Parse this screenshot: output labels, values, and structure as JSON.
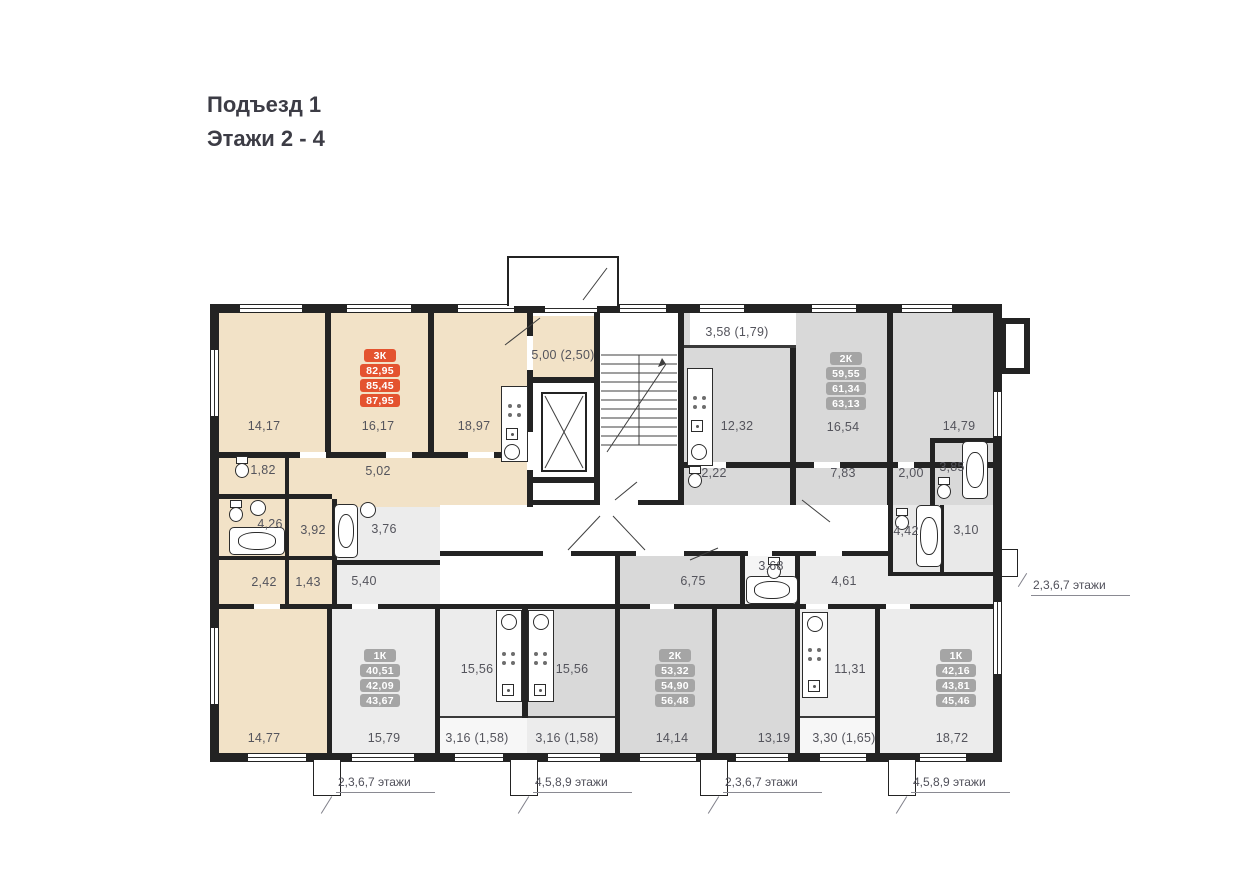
{
  "page": {
    "title_line1": "Подъезд 1",
    "title_line2": "Этажи 2 - 4"
  },
  "apartments": {
    "apt3k": {
      "type": "3К",
      "area1": "82,95",
      "area2": "85,45",
      "area3": "87,95"
    },
    "apt2k_top": {
      "type": "2К",
      "area1": "59,55",
      "area2": "61,34",
      "area3": "63,13"
    },
    "apt1k_left": {
      "type": "1К",
      "area1": "40,51",
      "area2": "42,09",
      "area3": "43,67"
    },
    "apt2k_bottom": {
      "type": "2К",
      "area1": "53,32",
      "area2": "54,90",
      "area3": "56,48"
    },
    "apt1k_right": {
      "type": "1К",
      "area1": "42,16",
      "area2": "43,81",
      "area3": "45,46"
    }
  },
  "rooms": {
    "r14_17": "14,17",
    "r16_17": "16,17",
    "r18_97": "18,97",
    "balc5_00": "5,00 (2,50)",
    "corr5_02": "5,02",
    "wc1_82": "1,82",
    "bath4_26": "4,26",
    "hall3_92": "3,92",
    "c2_42": "2,42",
    "c1_43": "1,43",
    "bath3_76": "3,76",
    "hall5_40": "5,40",
    "balc3_58": "3,58 (1,79)",
    "kit12_32": "12,32",
    "r16_54": "16,54",
    "r14_79": "14,79",
    "c2_22": "2,22",
    "c7_83": "7,83",
    "c2_00": "2,00",
    "bath3_85": "3,85",
    "bath4_42": "4,42",
    "c3_10": "3,10",
    "c6_75": "6,75",
    "bath3_68": "3,68",
    "c4_61": "4,61",
    "r14_77": "14,77",
    "r15_79": "15,79",
    "kit15_56l": "15,56",
    "kit15_56r": "15,56",
    "balc3_16l": "3,16 (1,58)",
    "balc3_16r": "3,16 (1,58)",
    "r14_14": "14,14",
    "r13_19": "13,19",
    "kit11_31": "11,31",
    "balc3_30": "3,30 (1,65)",
    "r18_72": "18,72"
  },
  "floor_labels": {
    "right": "2,3,6,7  этажи",
    "bottom1": "2,3,6,7  этажи",
    "bottom2": "4,5,8,9  этажи",
    "bottom3": "2,3,6,7  этажи",
    "bottom4": "4,5,8,9  этажи"
  },
  "colors": {
    "accent": "#e4532f",
    "badge_grey": "#a5a5a5",
    "apartment_beige": "#f2e2c7",
    "apartment_grey": "#d9d9d9",
    "apartment_light": "#ececec",
    "wall": "#232323"
  }
}
